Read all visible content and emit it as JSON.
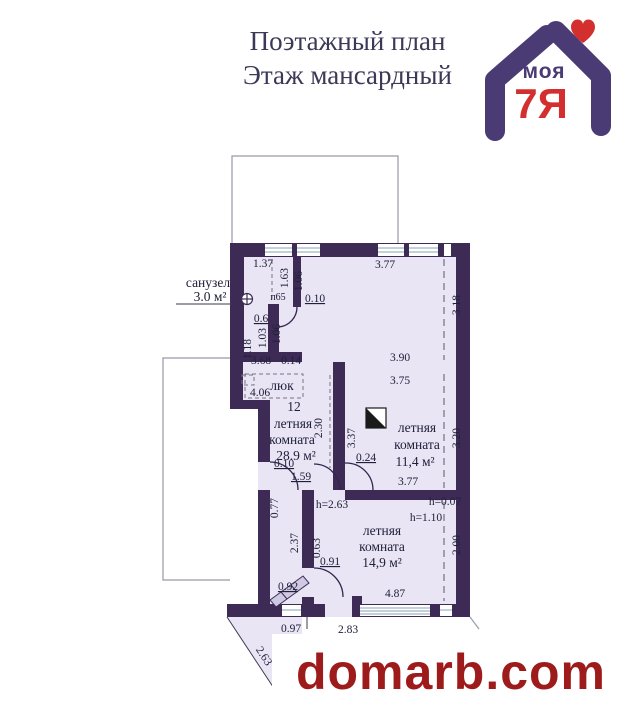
{
  "title": {
    "line1": "Поэтажный план",
    "line2": "Этаж  мансардный"
  },
  "logo": {
    "word": "моя",
    "mark": "7Я",
    "heart_icon": "heart",
    "colors": {
      "purple": "#4a3b75",
      "red": "#d32f2f"
    }
  },
  "watermark": {
    "text": "domarb.com",
    "color": "#9e1b1b"
  },
  "plan": {
    "colors": {
      "wall": "#3d2b55",
      "floor": "#e9e5f5",
      "ink": "#20203a"
    },
    "rooms": [
      {
        "name": "санузел",
        "area": "3.0 м²"
      },
      {
        "number": "12",
        "name1": "летняя",
        "name2": "комната",
        "area": "28.9 м²"
      },
      {
        "name1": "летняя",
        "name2": "комната",
        "area": "11,4 м²"
      },
      {
        "name1": "летняя",
        "name2": "комната",
        "area": "14,9 м²"
      }
    ],
    "hatch_label": "люк",
    "door_label": "п65",
    "dimensions": [
      {
        "t": "1.37",
        "x": 263,
        "y": 267
      },
      {
        "t": "1.63",
        "x": 288,
        "y": 278,
        "r": -90
      },
      {
        "t": "1.06",
        "x": 302,
        "y": 281,
        "r": -90
      },
      {
        "t": "3.77",
        "x": 385,
        "y": 268
      },
      {
        "t": "3.18",
        "x": 460,
        "y": 305,
        "r": -90
      },
      {
        "t": "0.10",
        "x": 315,
        "y": 302,
        "u": 1
      },
      {
        "t": "0.6",
        "x": 261,
        "y": 322,
        "u": 1
      },
      {
        "t": "1.03",
        "x": 266,
        "y": 338,
        "r": -90
      },
      {
        "t": "1.06",
        "x": 280,
        "y": 334,
        "r": -90
      },
      {
        "t": "1.18",
        "x": 251,
        "y": 349,
        "r": -90
      },
      {
        "t": "3.68",
        "x": 261,
        "y": 364
      },
      {
        "t": "0.14",
        "x": 291,
        "y": 364
      },
      {
        "t": "4.06",
        "x": 260,
        "y": 396
      },
      {
        "t": "3.90",
        "x": 400,
        "y": 361
      },
      {
        "t": "3.75",
        "x": 400,
        "y": 384
      },
      {
        "t": "2.30",
        "x": 322,
        "y": 428,
        "r": -90
      },
      {
        "t": "3.37",
        "x": 355,
        "y": 438,
        "r": -90
      },
      {
        "t": "0.24",
        "x": 366,
        "y": 461,
        "u": 1
      },
      {
        "t": "3.20",
        "x": 460,
        "y": 438,
        "r": -90
      },
      {
        "t": "0.10",
        "x": 284,
        "y": 467,
        "u": 1
      },
      {
        "t": "1.59",
        "x": 301,
        "y": 480,
        "u": 1
      },
      {
        "t": "3.77",
        "x": 408,
        "y": 485
      },
      {
        "t": "h=0.07",
        "x": 445,
        "y": 505
      },
      {
        "t": "h=1.10",
        "x": 426,
        "y": 521
      },
      {
        "t": "h=2.63",
        "x": 332,
        "y": 508
      },
      {
        "t": "0.77",
        "x": 278,
        "y": 508,
        "r": -90
      },
      {
        "t": "2.37",
        "x": 298,
        "y": 543,
        "r": -90
      },
      {
        "t": "0.63",
        "x": 320,
        "y": 548,
        "r": -90
      },
      {
        "t": "0.91",
        "x": 330,
        "y": 565,
        "u": 1
      },
      {
        "t": "2.00",
        "x": 460,
        "y": 545,
        "r": -90
      },
      {
        "t": "0.92",
        "x": 288,
        "y": 590,
        "u": 1
      },
      {
        "t": "4.87",
        "x": 395,
        "y": 597
      },
      {
        "t": "0.97",
        "x": 291,
        "y": 632
      },
      {
        "t": "2.83",
        "x": 348,
        "y": 633
      },
      {
        "t": "2.63",
        "x": 261,
        "y": 658,
        "r": 57
      }
    ]
  }
}
